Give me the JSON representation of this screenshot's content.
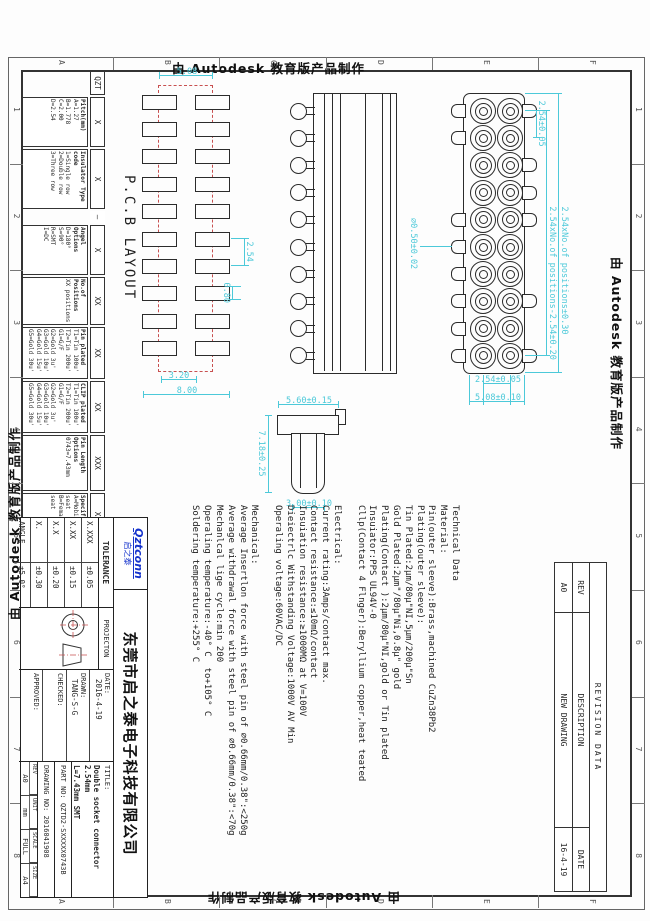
{
  "stamp": {
    "text": "由 Autodesk 教育版产品制作"
  },
  "frame": {
    "zone_letters": [
      "A",
      "B",
      "C",
      "D",
      "E",
      "F"
    ],
    "zone_numbers": [
      "1",
      "2",
      "3",
      "4",
      "5",
      "6",
      "7",
      "8"
    ]
  },
  "revision_table": {
    "title": "REVISION DATA",
    "headers": [
      "REV",
      "DESCRIPTION",
      "DATE"
    ],
    "rows": [
      [
        "A0",
        "NEW DRAWING",
        "16-4-19"
      ]
    ]
  },
  "pcb_view": {
    "label": "P.C.B LAYOUT",
    "cols": 10,
    "rows": 2,
    "dim_pitch": "2.54",
    "dim_pad_w": "0.80",
    "dim_row_gap": "5.08",
    "dim_inner": "3.20",
    "dim_overall": "8.00"
  },
  "front_view": {
    "cols": 10,
    "rows": 2,
    "top_leads": [
      1,
      3,
      4,
      5,
      8,
      10
    ],
    "bottom_leads": [
      1,
      2,
      5,
      6,
      7,
      8,
      9,
      10
    ],
    "dim_overall": "2.54xNo.of positions±0.30",
    "dim_span": "2.54xNo.of positions-2.54±0.20",
    "dim_pitch": "2.54±0.05",
    "dim_row_pitch": "2.54±0.05",
    "dim_height": "5.08±0.10",
    "dim_lead": "∅0.50±0.02"
  },
  "side_view": {
    "pins": 10
  },
  "pin_detail": {
    "dim_width": "7.18±0.25",
    "dim_h_left": "5.60±0.15",
    "dim_h_right": "3.00±0.10"
  },
  "tech_text": {
    "lines": [
      "Technical Data",
      "Material:",
      "Pin(outer sleeve):Brass,machined CuZn38Pb2",
      "Plating(outer sleeve):",
      "Tin Plated:2μm/80μ\"NI,5μm/200μ\"Sn",
      "Gold Plated:2μm\"/80μ\"Ni,0.8μ\" gold",
      "Plating(Contact ):2μm/80μ\"NI,gold or Tin plated",
      "Insuiator:PPS UL94V-0",
      "Cllp(Contact 4 Flnger):Beryllium copper,heat teated",
      "",
      "Electrical:",
      "Current rating:3Amps/contact max.",
      "Contact resistance:≤10mΩ/contact",
      "Insuiation resistance:≥1000MΩ at V=100V",
      "Dieiectrlc Withstanding Voltage:1000V AV Min",
      "Operaling voltage:60VAC/DC",
      "",
      "Mechanical:",
      "Average Insertlon force with steel pin of ∅0.66mm/0.38\":<250g",
      "Average withdrawal force with steel pin of ∅0.66mm/0.38\":<70g",
      "Mechanlcal lige cycle:min 200",
      "Operaling temperature:-40° C  to+105° C",
      "Soldering temperature:+255° C"
    ]
  },
  "ordering": {
    "segments": [
      {
        "code": "QZT",
        "lines": []
      },
      {
        "code": "X",
        "lines": [
          "Pitch(mm)",
          "A=1.27",
          "B=1.778",
          "C=2.00",
          "D=2.54"
        ]
      },
      {
        "code": "X",
        "lines": [
          "Insulator Type code",
          "1=Single row",
          "2=Double row",
          "3=Three row"
        ]
      },
      {
        "code": "—",
        "lines": []
      },
      {
        "code": "X",
        "lines": [
          "Angel Options",
          "D=180°",
          "S=90°",
          "R=SMT",
          "I=DC"
        ]
      },
      {
        "code": "XX",
        "lines": [
          "No.of Positions",
          "XX positions"
        ]
      },
      {
        "code": "XX",
        "lines": [
          "Pin plated",
          "T1=Tin 100u'",
          "T2=Tin 200u'",
          "G1=G/F",
          "G2=Gold 3u'",
          "G3=Gold 10u'",
          "G4=Gold 15u'",
          "G5=Gold 30u'"
        ]
      },
      {
        "code": "XX",
        "lines": [
          "CLIP plated",
          "T1=Tin 100u'",
          "T2=Tin 200u'",
          "G1=G/F",
          "G2=Gold 3u'",
          "G3=Gold 10u'",
          "G4=Gold 15u'",
          "G5=Gold 30u'"
        ]
      },
      {
        "code": "XXX",
        "lines": [
          "Pin Length Options",
          "0743=7.43mm"
        ]
      },
      {
        "code": "X",
        "lines": [
          "Specifications",
          "A=Mobile seat",
          "B=Female seat"
        ]
      }
    ],
    "widths": [
      24,
      50,
      60,
      12,
      50,
      48,
      52,
      52,
      56,
      42
    ]
  },
  "title_block": {
    "tolerance": {
      "header": "TOLERANCE",
      "rows": [
        [
          "X.XXX",
          "±0.05"
        ],
        [
          "X.XX",
          "±0.15"
        ],
        [
          "X.X",
          "±0.20"
        ],
        [
          "X.",
          "±0.30"
        ],
        [
          "ANGLE",
          "±5.0°"
        ]
      ]
    },
    "projection_label": "PROJECTON",
    "fields": {
      "date_label": "DATE:",
      "date": "2016-4-19",
      "drawn_label": "DRAWN:",
      "drawn": "TANG-S-G",
      "checked_label": "CHECKED:",
      "checked": "",
      "approved_label": "APPROVED:",
      "approved": ""
    },
    "title_label": "TITLE:",
    "title_line1": "Double socket connector 2.54mm",
    "title_line2": "L=7.43mm SMT",
    "part_label": "PART NO:",
    "part_no": "QZTD2-SXXXXX0743B",
    "drawing_label": "DRAWING NO:",
    "drawing_no": "2016041908",
    "mini": {
      "labels": [
        "REV",
        "UNIT",
        "SCALE",
        "SIZE"
      ],
      "values": [
        "A0",
        "mm",
        "FULL",
        "A4"
      ]
    },
    "company": "东莞市启之泰电子科技有限公司",
    "logo_top": "Qztconn",
    "logo_bottom": "启之泰"
  },
  "colors": {
    "dim": "#4cc9d9",
    "center": "#c85050",
    "line": "#2b2b2b",
    "frame": "#333333",
    "logo": "#1533cc"
  }
}
